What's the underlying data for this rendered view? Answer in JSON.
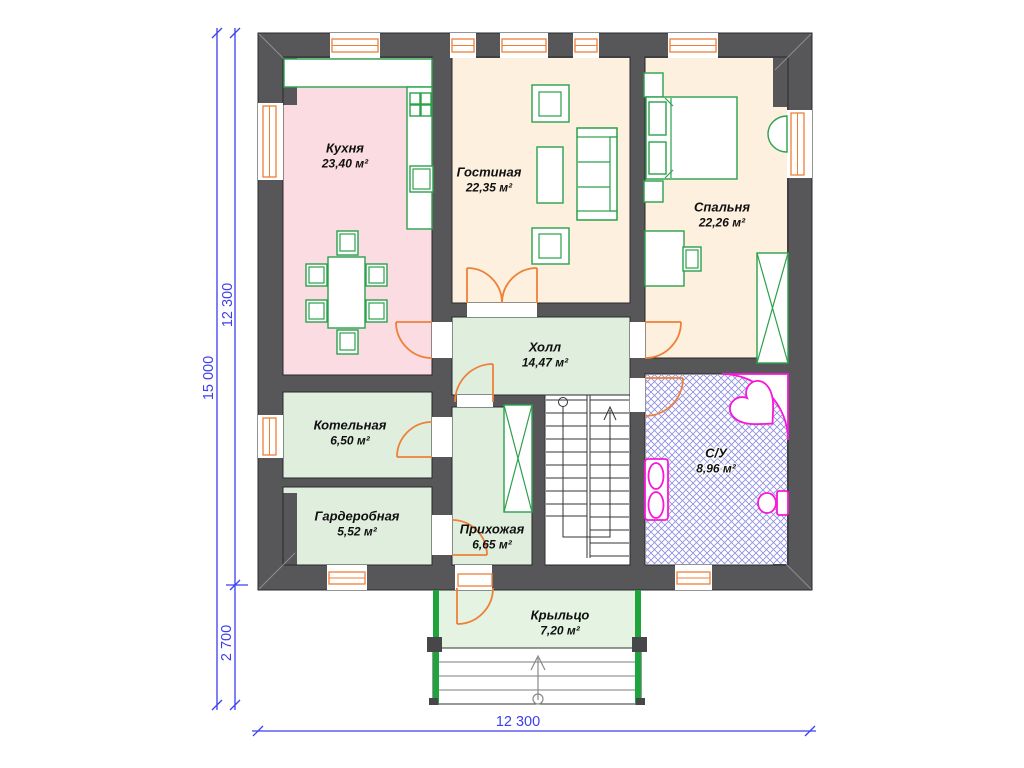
{
  "rooms": [
    {
      "name": "Кухня",
      "area": "23,40 м²"
    },
    {
      "name": "Гостиная",
      "area": "22,35 м²"
    },
    {
      "name": "Спальня",
      "area": "22,26 м²"
    },
    {
      "name": "Холл",
      "area": "14,47 м²"
    },
    {
      "name": "Котельная",
      "area": "6,50 м²"
    },
    {
      "name": "Гардеробная",
      "area": "5,52 м²"
    },
    {
      "name": "Прихожая",
      "area": "6,65 м²"
    },
    {
      "name": "С/У",
      "area": "8,96 м²"
    },
    {
      "name": "Крыльцо",
      "area": "7,20 м²"
    }
  ],
  "dimensions": {
    "overall_height": "15 000",
    "main_height": "12 300",
    "porch_height": "2 700",
    "overall_width": "12 300"
  },
  "colors": {
    "wall": "#57575a",
    "floor-pink": "#fadce2",
    "floor-cream": "#fdf0df",
    "floor-green": "#dfeedd",
    "floor-porch": "#e4f3e2",
    "furniture": "#2ba14b",
    "door": "#ef8038",
    "fixture": "#f718d8",
    "dim": "#3d3df2",
    "hatch": "#9191e2",
    "stair": "#333333",
    "step": "#a8a8a8"
  }
}
